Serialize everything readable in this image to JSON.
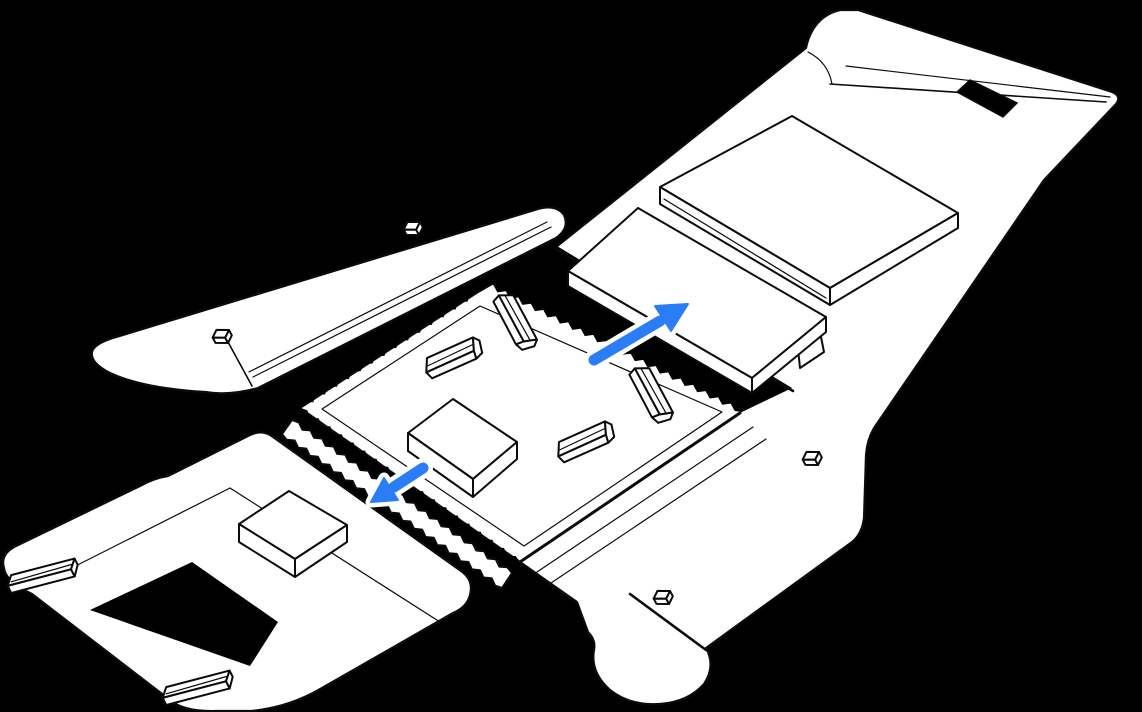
{
  "illustration": {
    "name": "unfolded-shipping-box-packing-diagram",
    "parts": [
      "shipping-box-blank-unfolded",
      "center-tray-with-tear-strips",
      "corner-protectors",
      "accessory-box-on-tray",
      "accessory-box-on-end-flap",
      "wrapped-computer-stack",
      "lid-panel-with-handle-cutout",
      "side-strip-with-tabs",
      "end-flap-with-rail-tabs"
    ],
    "icons": [
      {
        "name": "arrow-up-right-icon",
        "direction": "up-right"
      },
      {
        "name": "arrow-down-left-icon",
        "direction": "down-left"
      }
    ]
  },
  "colors": {
    "background": "#000000",
    "line": "#0b0b0b",
    "cardboard": "#ffffff",
    "accent": "#2a7df7",
    "halo": "#ffffff"
  }
}
